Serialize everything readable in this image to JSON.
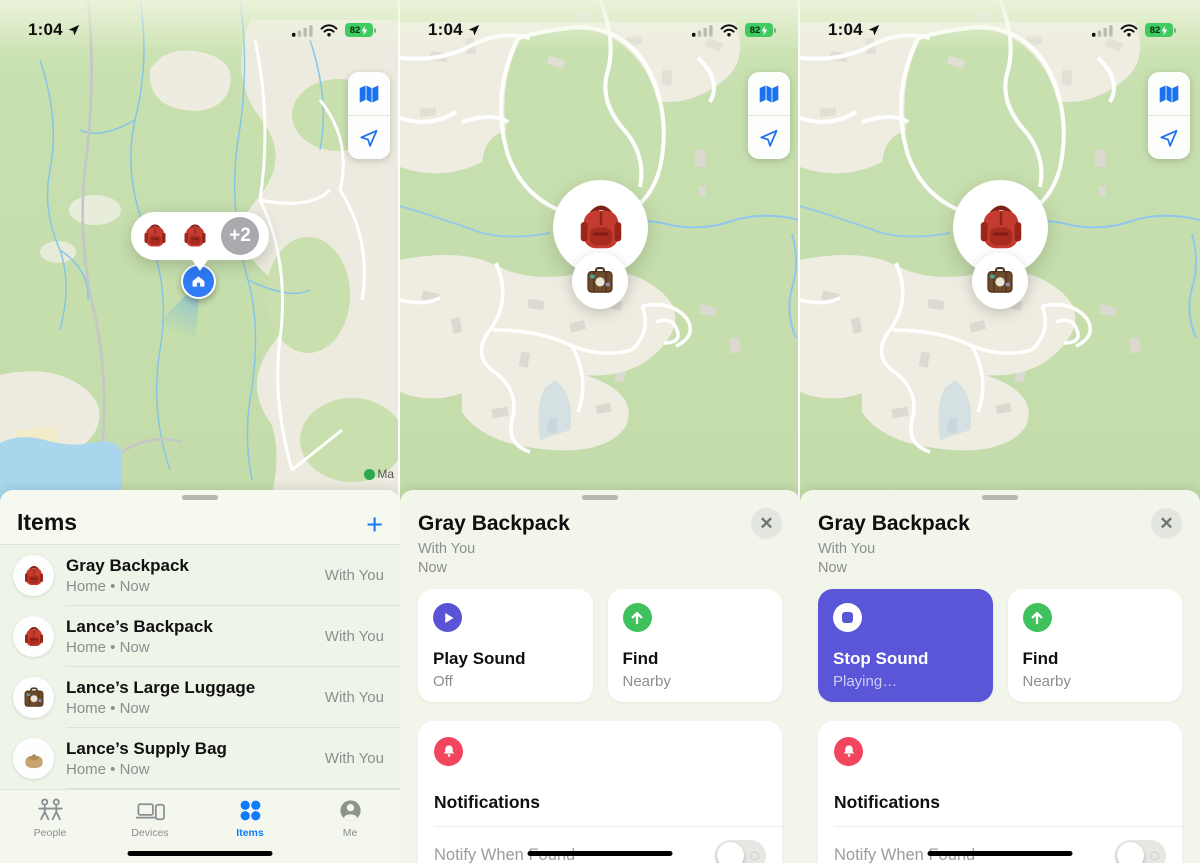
{
  "status": {
    "time": "1:04",
    "battery": "82"
  },
  "colors": {
    "accent_blue": "#107bfd",
    "indigo": "#5b56d8",
    "green": "#3fc15e",
    "red": "#f2455e",
    "battery_green": "#3ecb5f"
  },
  "panels": {
    "list": {
      "title": "Items",
      "add": "+",
      "map": {
        "cluster_more": "+2",
        "legal": "Ma"
      },
      "items": [
        {
          "name": "Gray Backpack",
          "meta": "Home • Now",
          "status": "With You",
          "icon": "red-backpack"
        },
        {
          "name": "Lance’s Backpack",
          "meta": "Home • Now",
          "status": "With You",
          "icon": "red-backpack"
        },
        {
          "name": "Lance’s Large Luggage",
          "meta": "Home • Now",
          "status": "With You",
          "icon": "brown-luggage"
        },
        {
          "name": "Lance’s Supply Bag",
          "meta": "Home • Now",
          "status": "With You",
          "icon": "tan-bag"
        }
      ],
      "tabs": [
        {
          "label": "People"
        },
        {
          "label": "Devices"
        },
        {
          "label": "Items",
          "active": true
        },
        {
          "label": "Me"
        }
      ]
    },
    "detail_play": {
      "title": "Gray Backpack",
      "subtitle": "With You",
      "updated": "Now",
      "close": "✕",
      "actions": [
        {
          "title": "Play Sound",
          "subtitle": "Off",
          "icon": "play"
        },
        {
          "title": "Find",
          "subtitle": "Nearby",
          "icon": "arrow-up"
        }
      ],
      "notifications": {
        "title": "Notifications",
        "row_label": "Notify When Found"
      }
    },
    "detail_stop": {
      "title": "Gray Backpack",
      "subtitle": "With You",
      "updated": "Now",
      "close": "✕",
      "actions": [
        {
          "title": "Stop Sound",
          "subtitle": "Playing…",
          "icon": "stop"
        },
        {
          "title": "Find",
          "subtitle": "Nearby",
          "icon": "arrow-up"
        }
      ],
      "notifications": {
        "title": "Notifications",
        "row_label": "Notify When Found"
      }
    }
  }
}
